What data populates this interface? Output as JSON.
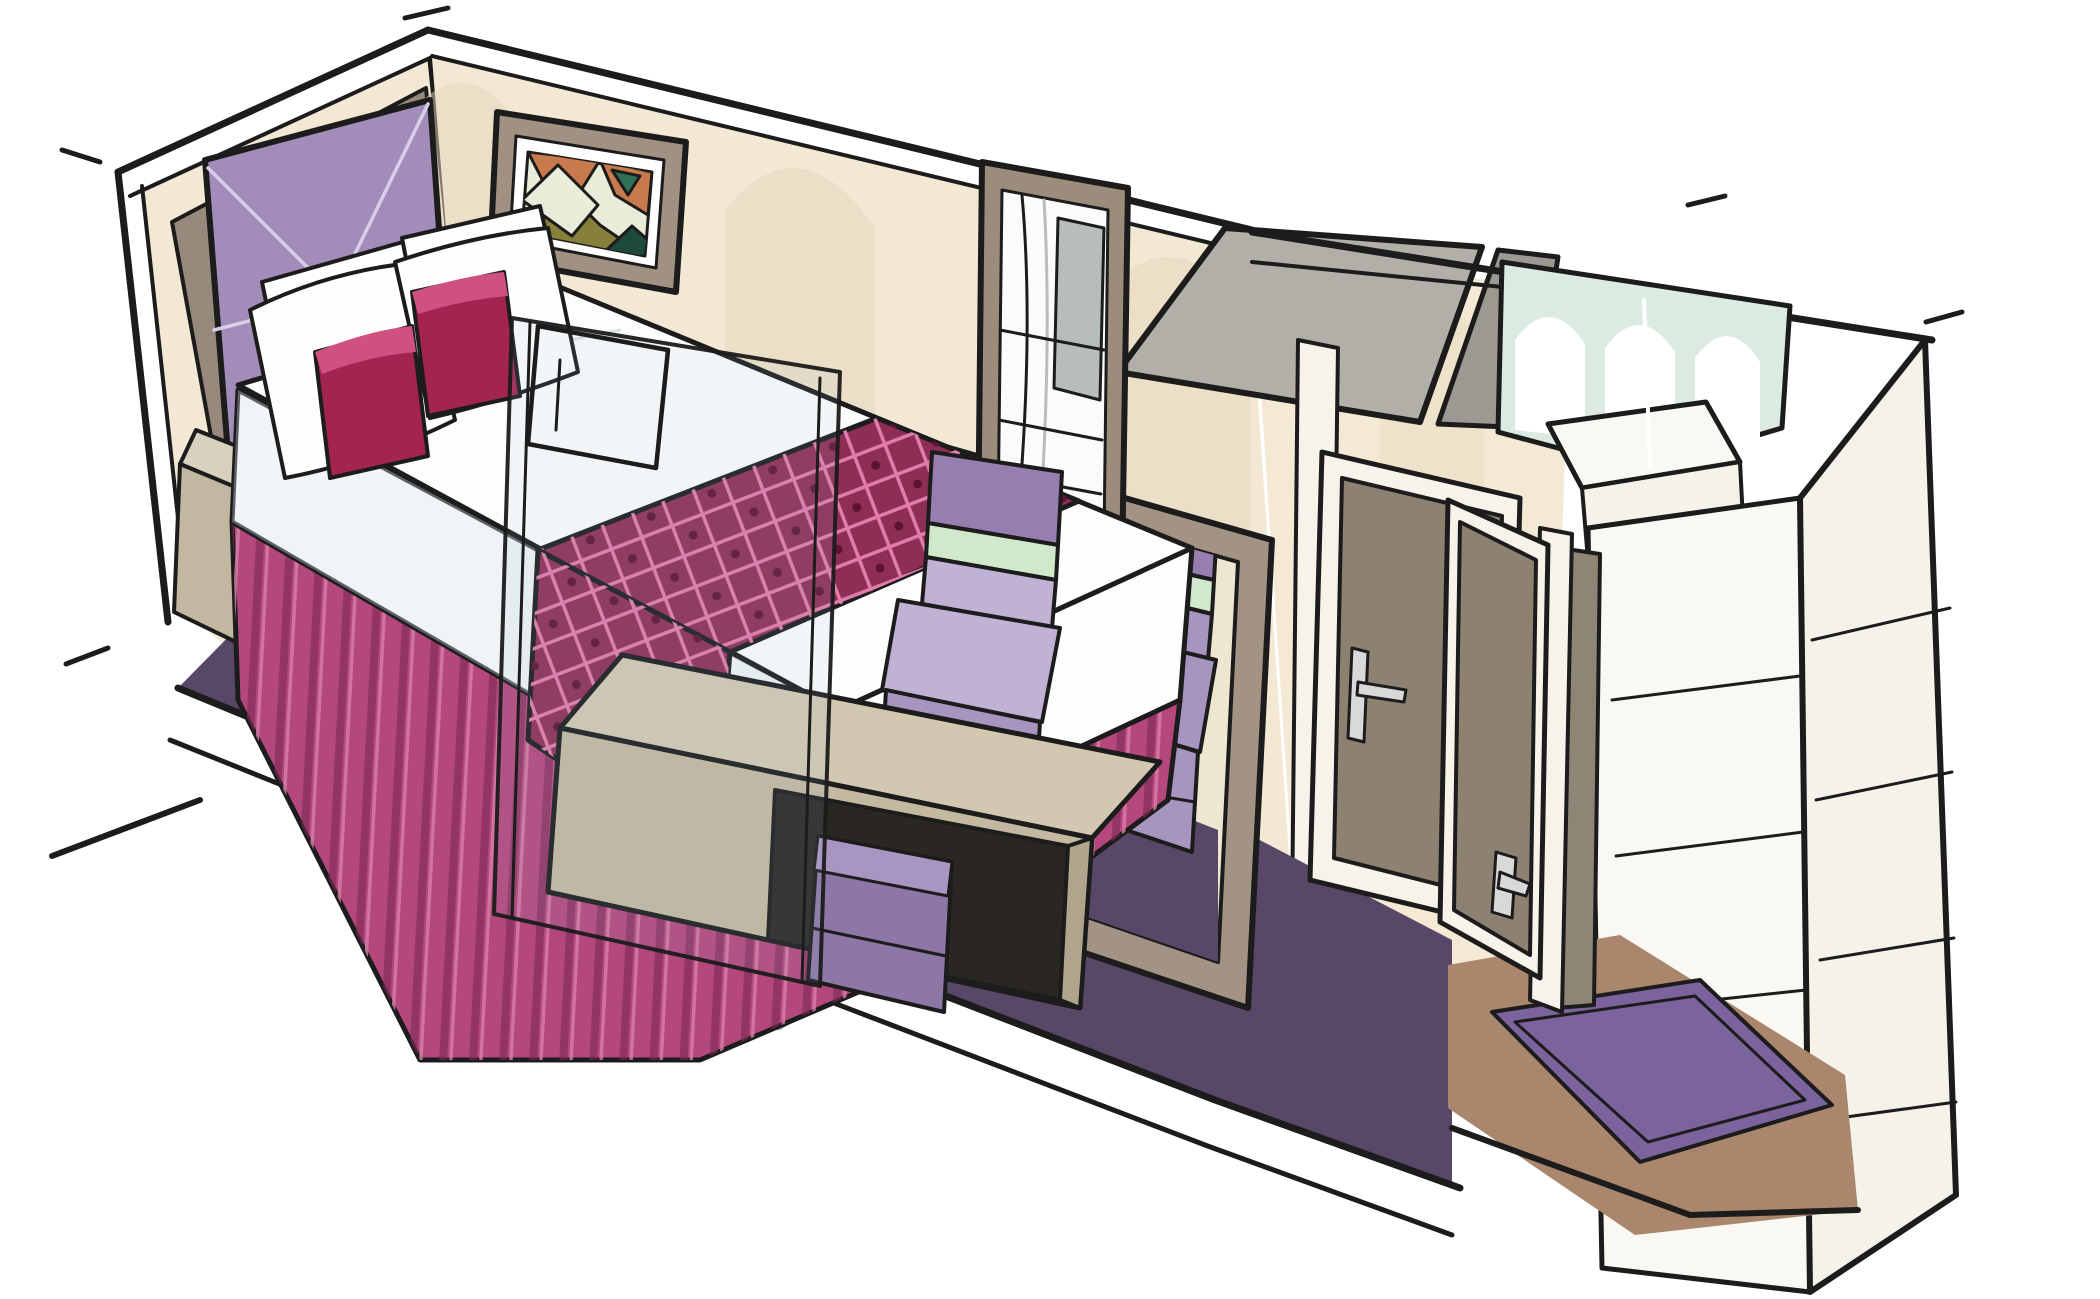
{
  "illustration": {
    "subject": "hotel-room-cutaway-sketch",
    "style": "watercolor-marker-perspective-drawing",
    "rooms": [
      "bedroom",
      "bathroom",
      "entry-hall"
    ]
  },
  "scene": {
    "elements": [
      {
        "name": "feature-wall-panel",
        "color_ref": "feature_wall_taupe"
      },
      {
        "name": "quilted-headboard",
        "color_ref": "headboard_purple"
      },
      {
        "name": "double-bed-duvet",
        "color_ref": "duvet_white"
      },
      {
        "name": "patterned-bed-runner",
        "color_ref": "runner_plum"
      },
      {
        "name": "pleated-bed-skirt",
        "color_ref": "skirt_pink"
      },
      {
        "name": "white-pillows",
        "color_ref": "pillow_white"
      },
      {
        "name": "magenta-accent-cushions",
        "color_ref": "cushion_magenta"
      },
      {
        "name": "geometric-shelf-nightstand",
        "color_ref": "nightstand_light"
      },
      {
        "name": "abstract-framed-artwork",
        "color_ref": "art_frame_taupe"
      },
      {
        "name": "arched-wall-wash",
        "color_ref": "wall_shade"
      },
      {
        "name": "curtain-mirror-panel",
        "color_ref": "window_frame_taupe"
      },
      {
        "name": "vanity-mirror",
        "color_ref": "mirror_frame_taupe"
      },
      {
        "name": "lilac-chair",
        "color_ref": "chair_lilac"
      },
      {
        "name": "lilac-chair-reflection",
        "color_ref": "chair_lilac_dark"
      },
      {
        "name": "vanity-desk",
        "color_ref": "desk_top"
      },
      {
        "name": "purple-ottoman",
        "color_ref": "stool_purple"
      },
      {
        "name": "glass-tv-panel",
        "color_ref": "glass_tint"
      },
      {
        "name": "purple-carpet",
        "color_ref": "carpet_purple"
      },
      {
        "name": "sloped-ceiling-panel",
        "color_ref": "ceiling_gray"
      },
      {
        "name": "bathroom-arched-wall",
        "color_ref": "bathroom_aqua"
      },
      {
        "name": "shower-enclosure",
        "color_ref": "wardrobe_white"
      },
      {
        "name": "bathroom-door",
        "color_ref": "door_brown"
      },
      {
        "name": "open-entry-door",
        "color_ref": "door_brown"
      },
      {
        "name": "door-handle",
        "color_ref": "handle_silver"
      },
      {
        "name": "entry-floor",
        "color_ref": "entry_floor_brown"
      },
      {
        "name": "entry-rug",
        "color_ref": "entry_rug_purple"
      },
      {
        "name": "wardrobe-shelves",
        "color_ref": "wardrobe_white"
      },
      {
        "name": "exterior-cut-wall",
        "color_ref": "exterior_white"
      }
    ]
  },
  "colors": {
    "paper": "#ffffff",
    "ink": "#1c1c1c",
    "wall_cream": "#f2e8d4",
    "wall_shade": "#e5d6ba",
    "corridor_wall": "#f3e9d5",
    "feature_wall_taupe": "#97897b",
    "feature_wall_dark": "#857666",
    "baseboard_cream": "#efe8d8",
    "headboard_purple": "#a28cba",
    "headboard_seam": "#d9cdea",
    "pillow_white": "#fefefe",
    "pillow_shade": "#c9d5dd",
    "cushion_magenta": "#a32450",
    "cushion_light": "#cf5180",
    "cushion_dark": "#76163a",
    "duvet_white": "#fdfdfd",
    "duvet_shade": "#d7e1e7",
    "runner_plum": "#8e2e55",
    "runner_lattice_pink": "#e27cab",
    "runner_dot": "#5c1332",
    "skirt_pink": "#b4477c",
    "skirt_dark": "#7c2955",
    "skirt_light": "#d77fa8",
    "carpet_purple": "#594767",
    "carpet_dark": "#43354f",
    "nightstand_light": "#d9d0bd",
    "nightstand_mid": "#c2b7a0",
    "nightstand_dark": "#9d9079",
    "art_frame_taupe": "#a09182",
    "art_mat": "#ffffff",
    "art_bg": "#e9ecd8",
    "art_orange": "#c97a4c",
    "art_olive": "#86803a",
    "art_teal": "#2f7057",
    "art_teal_dark": "#1e4a3c",
    "window_frame_taupe": "#9b8c7b",
    "curtain_white": "#fbfbfb",
    "curtain_gray": "#b7bcbc",
    "mirror_frame_taupe": "#a29384",
    "mirror_cream": "#efe6d1",
    "chair_lilac": "#c0b2d5",
    "chair_lilac_dark": "#a795c0",
    "chair_purple": "#967fb0",
    "chair_mint": "#cfe9ca",
    "desk_top": "#d2c8b2",
    "desk_front": "#c3b8a0",
    "desk_side": "#b0a58c",
    "cubby_dark": "#2a2723",
    "stool_purple": "#8d77a6",
    "stool_light": "#a995c1",
    "glass_tint": "#9fb4c2",
    "ceiling_gray": "#b2afa8",
    "ceiling_gray_dark": "#9c9992",
    "bathroom_aqua": "#dcebe2",
    "arch_white": "#ffffff",
    "door_brown": "#8d8172",
    "door_brown_dark": "#7a6e5f",
    "door_frame_white": "#f7f3ea",
    "doorway_shadow": "#8f8577",
    "entry_floor_brown": "#a9866c",
    "entry_rug_purple": "#7b649d",
    "exterior_white": "#f5f2ea",
    "wardrobe_white": "#faf8f2",
    "handle_silver": "#d9d9d9",
    "shadow_purple": "#3e3350"
  }
}
